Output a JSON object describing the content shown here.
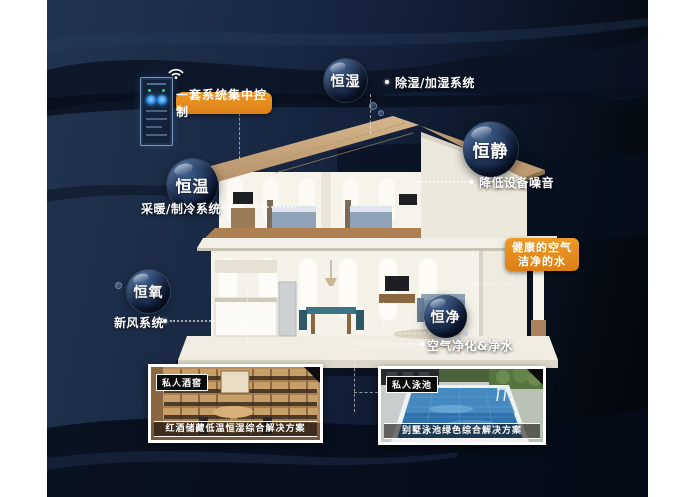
{
  "page": {
    "background_color": "#1a2a45",
    "accent_color": "#E2861B"
  },
  "control": {
    "label": "一套系统集中控制"
  },
  "features": [
    {
      "bubble": "恒湿",
      "label": "除湿/加湿系统"
    },
    {
      "bubble": "恒静",
      "label": "降低设备噪音"
    },
    {
      "bubble": "恒温",
      "label": "采暖/制冷系统"
    },
    {
      "bubble": "恒氧",
      "label": "新风系统"
    },
    {
      "bubble": "恒净",
      "label": "空气净化&净水"
    }
  ],
  "callout": {
    "line1": "健康的空气",
    "line2": "洁净的水"
  },
  "cards": [
    {
      "badge": "私人酒窖",
      "caption": "红酒储藏低温恒湿综合解决方案"
    },
    {
      "badge": "私人泳池",
      "caption": "别墅泳池绿色综合解决方案"
    }
  ]
}
